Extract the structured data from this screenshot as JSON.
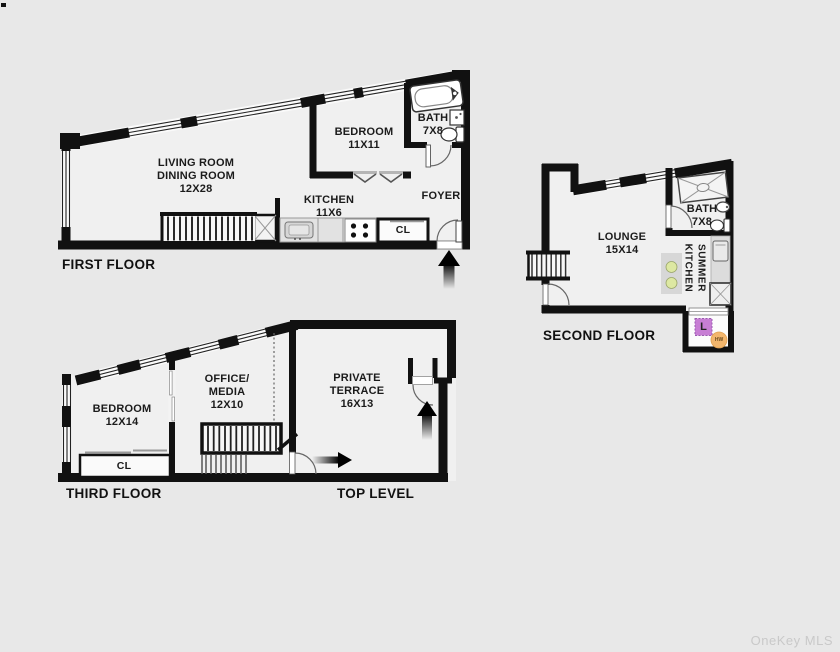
{
  "watermark": "OneKey MLS",
  "colors": {
    "background": "#e8e8e8",
    "wall": "#111111",
    "laundry_box": "#c77ed4",
    "hot_water_circle": "#f2b66d",
    "burner_green": "#dde8a2",
    "watermark_gray": "#c9c9c9"
  },
  "floors": {
    "first": {
      "title": "FIRST FLOOR",
      "rooms": {
        "living": {
          "line1": "LIVING ROOM",
          "line2": "DINING ROOM",
          "dims": "12X28"
        },
        "bedroom": {
          "name": "BEDROOM",
          "dims": "11X11"
        },
        "bath": {
          "name": "BATH",
          "dims": "7X8"
        },
        "kitchen": {
          "name": "KITCHEN",
          "dims": "11X6"
        },
        "foyer": {
          "name": "FOYER"
        },
        "closet": {
          "name": "CL"
        }
      }
    },
    "second": {
      "title": "SECOND FLOOR",
      "rooms": {
        "lounge": {
          "name": "LOUNGE",
          "dims": "15X14"
        },
        "bath": {
          "name": "BATH",
          "dims": "7X8"
        },
        "summer_kitchen": {
          "line1": "SUMMER",
          "line2": "KITCHEN"
        },
        "laundry": {
          "abbr": "L"
        },
        "hot_water": {
          "abbr": "HW"
        }
      }
    },
    "third": {
      "title": "THIRD FLOOR",
      "top_level_title": "TOP LEVEL",
      "rooms": {
        "bedroom": {
          "name": "BEDROOM",
          "dims": "12X14"
        },
        "office": {
          "line1": "OFFICE/",
          "line2": "MEDIA",
          "dims": "12X10"
        },
        "terrace": {
          "line1": "PRIVATE",
          "line2": "TERRACE",
          "dims": "16X13"
        },
        "closet": {
          "name": "CL"
        }
      }
    }
  }
}
